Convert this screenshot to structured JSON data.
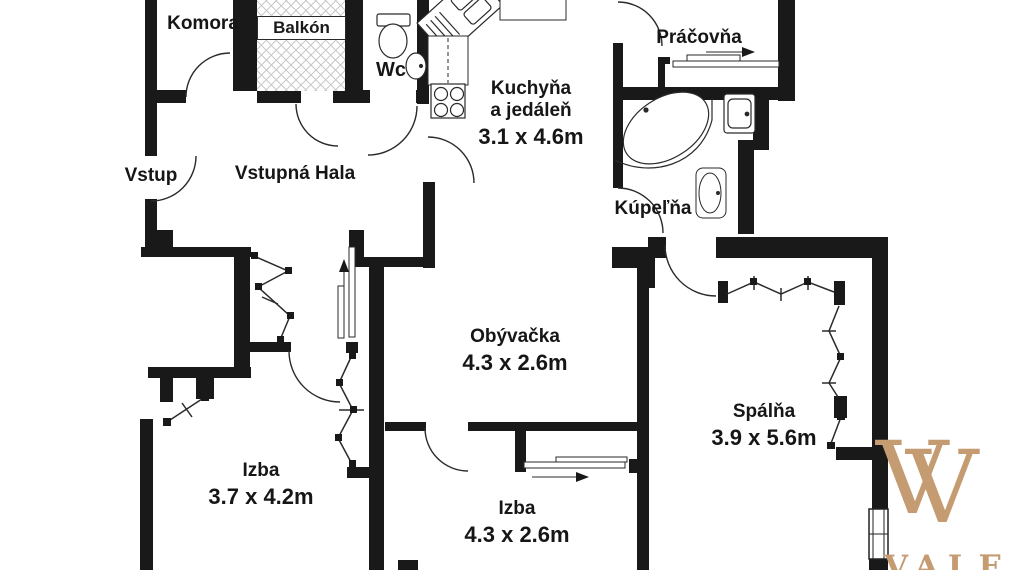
{
  "rooms": {
    "komora": {
      "name": "Komora"
    },
    "balkon": {
      "name": "Balkón"
    },
    "wc": {
      "name": "Wc"
    },
    "kuchyna": {
      "name": "Kuchyňa",
      "name2": "a jedáleň",
      "dims": "3.1 x 4.6m"
    },
    "pracovna": {
      "name": "Práčovňa"
    },
    "vstup": {
      "name": "Vstup"
    },
    "hala": {
      "name": "Vstupná Hala"
    },
    "kupelna": {
      "name": "Kúpeľňa"
    },
    "obyvacka": {
      "name": "Obývačka",
      "dims": "4.3 x 2.6m"
    },
    "spalna": {
      "name": "Spálňa",
      "dims": "3.9 x 5.6m"
    },
    "izba1": {
      "name": "Izba",
      "dims": "3.7 x 4.2m"
    },
    "izba2": {
      "name": "Izba",
      "dims": "4.3 x 2.6m"
    }
  },
  "watermark": {
    "logo_letter_1": "V",
    "logo_letter_2": "V",
    "brand_text": "VALEN",
    "color": "#c59b72"
  },
  "colors": {
    "wall": "#191919",
    "line": "#2a2a2a",
    "hatch": "#c9c9c9",
    "background": "#ffffff"
  }
}
